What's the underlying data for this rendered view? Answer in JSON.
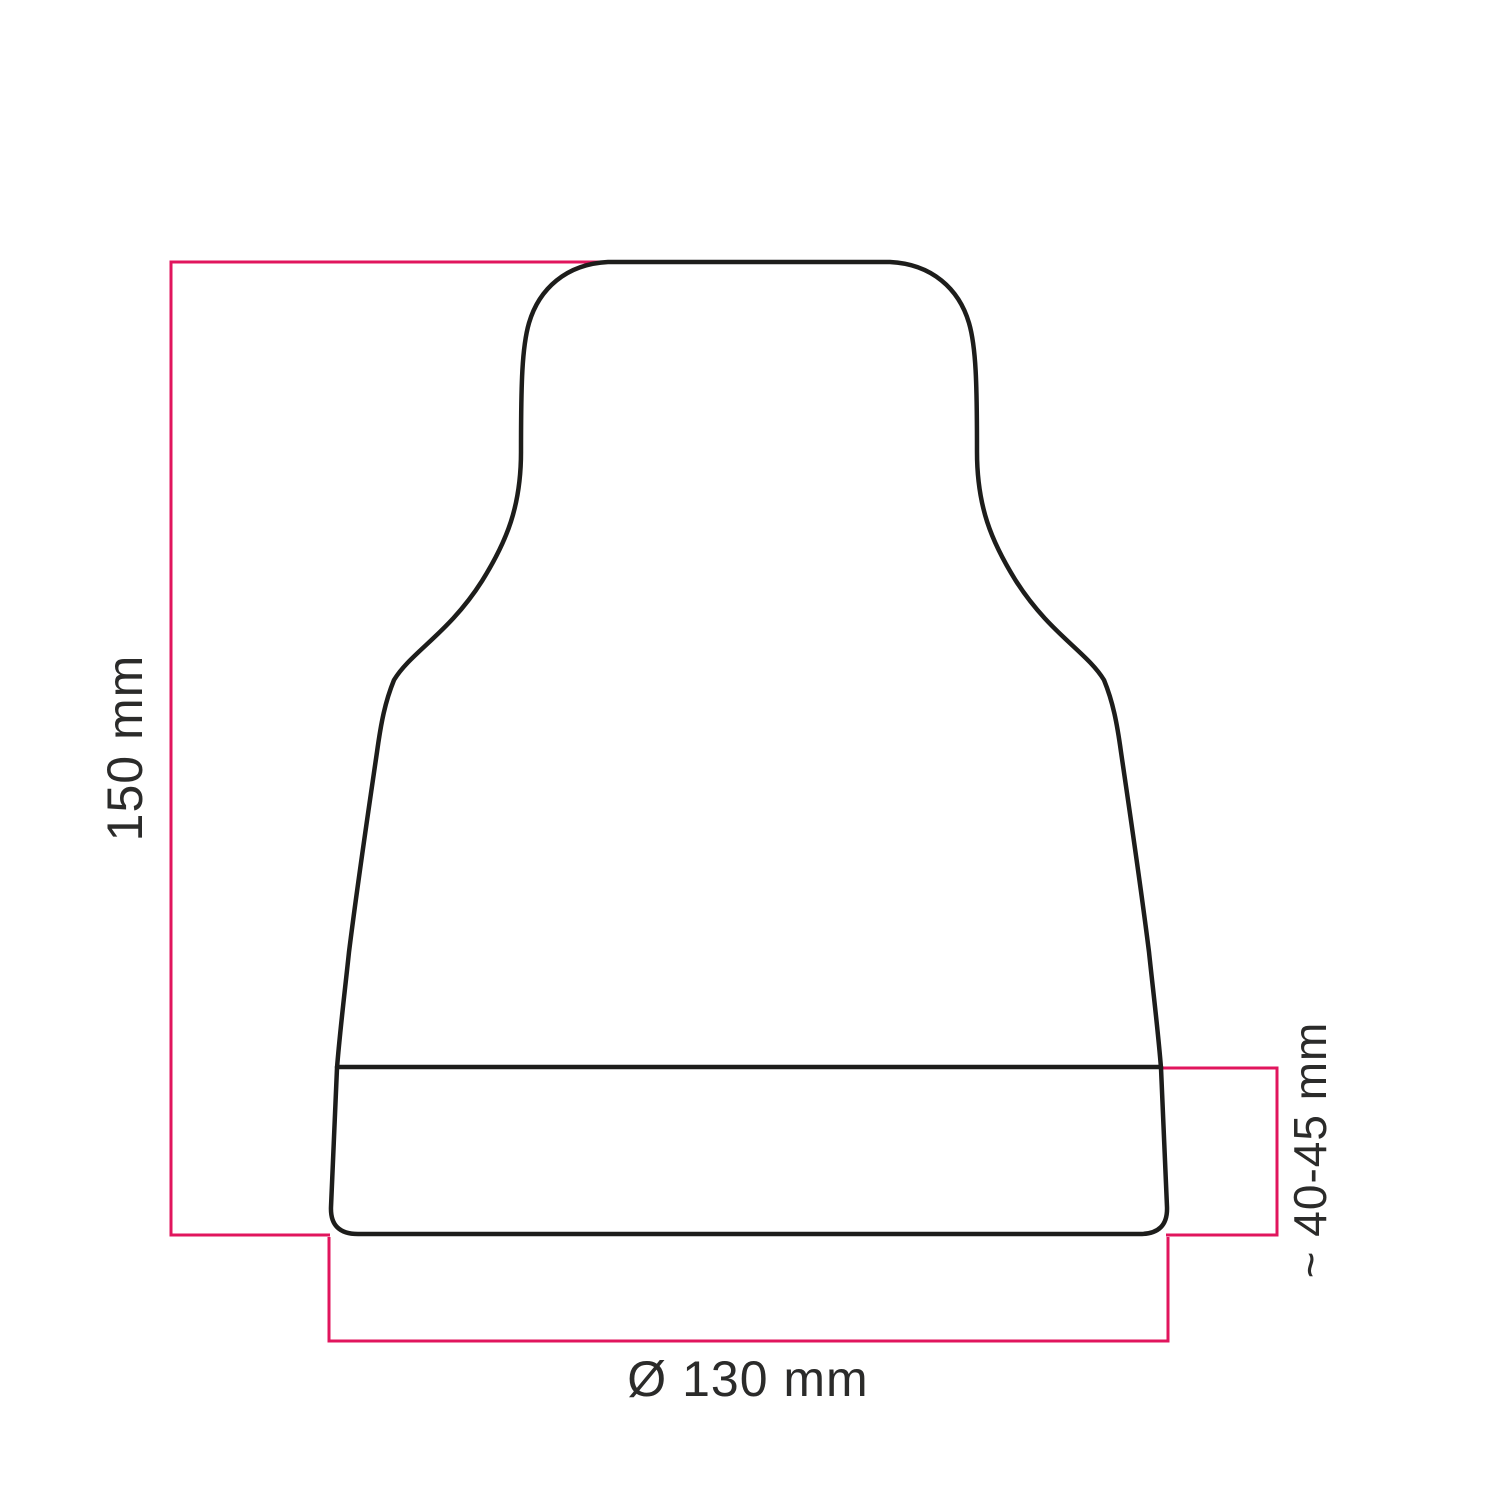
{
  "diagram": {
    "title": "lampshade dimension drawing",
    "labels": {
      "height": "150 mm",
      "base_band_height": "~ 40-45 mm",
      "diameter": "Ø 130 mm"
    },
    "colors": {
      "background": "#ffffff",
      "outline": "#1d1d1b",
      "dimension": "#e1155d",
      "text": "#2b2b2a"
    }
  }
}
